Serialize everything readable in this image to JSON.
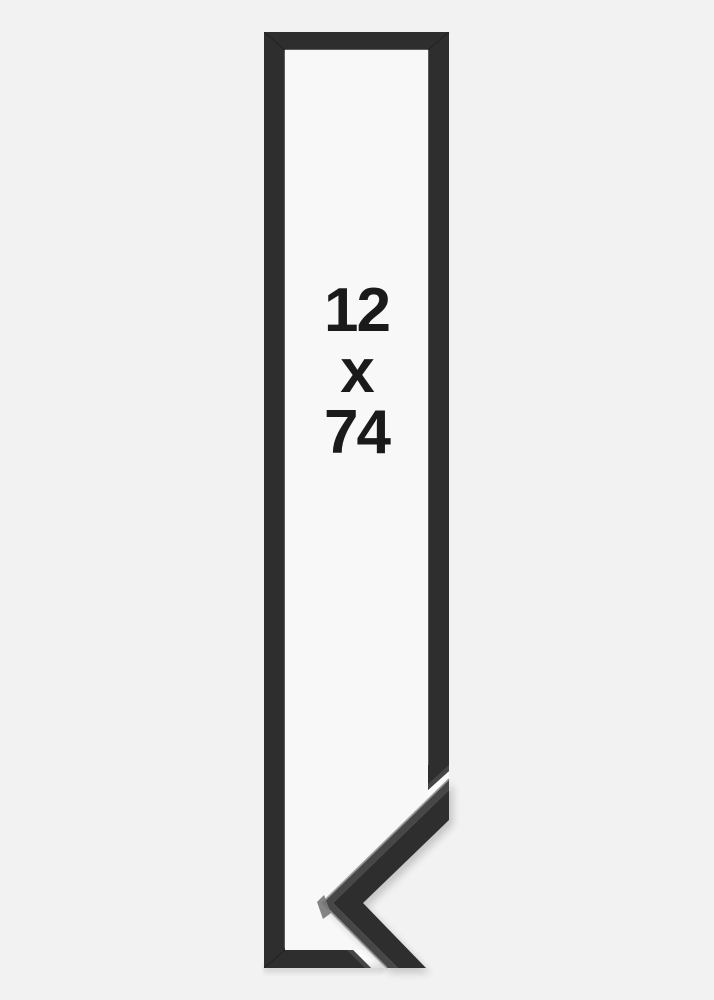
{
  "size_label": {
    "width": "12",
    "separator": "x",
    "height": "74"
  },
  "colors": {
    "background": "#f2f2f2",
    "interior": "#f8f8f8",
    "gap_light": "#fcfcfc",
    "frame": "#2e2e2e",
    "frame_cut_facet": "#464646",
    "frame_side": "#474747",
    "edge_highlight": "#989898",
    "tip_facet": "#787878",
    "shadow": "#000000",
    "label_text": "#1a1a1a"
  }
}
